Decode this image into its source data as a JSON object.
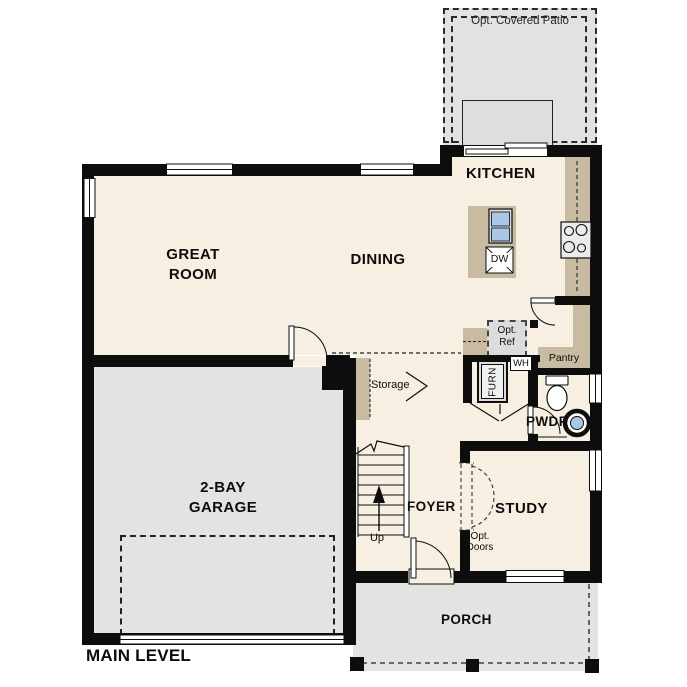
{
  "plan": {
    "title": "MAIN LEVEL",
    "rooms": {
      "patio": "Opt. Covered Patio",
      "kitchen": "KITCHEN",
      "great_1": "GREAT",
      "great_2": "ROOM",
      "dining": "DINING",
      "garage_1": "2-BAY",
      "garage_2": "GARAGE",
      "foyer": "FOYER",
      "study": "STUDY",
      "powder": "PWDR",
      "porch": "PORCH"
    },
    "features": {
      "storage": "Storage",
      "pantry": "Pantry",
      "up": "Up",
      "water_heater": "WH",
      "furnace": "FURN",
      "dishwasher": "DW",
      "opt_ref_1": "Opt.",
      "opt_ref_2": "Ref",
      "opt_doors_1": "Opt.",
      "opt_doors_2": "Doors"
    },
    "colors": {
      "wall": "#0d0d0d",
      "interior_floor": "#f6efe2",
      "exterior_floor": "#e3e3e1",
      "casework_tan": "#c9bba2",
      "sink_blue": "#a9c7e6",
      "optional_item_fill": "#dcdcdc",
      "background": "#ffffff"
    }
  }
}
